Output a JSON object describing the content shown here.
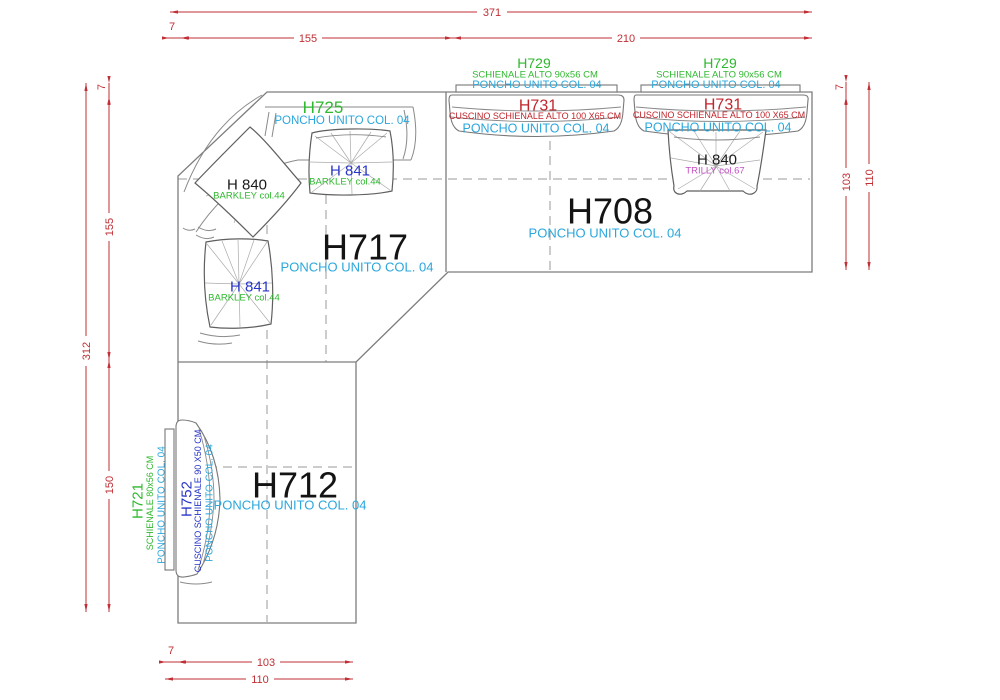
{
  "sections": {
    "h717": {
      "code": "H717",
      "fabric": "PONCHO UNITO COL. 04"
    },
    "h708": {
      "code": "H708",
      "fabric": "PONCHO UNITO COL. 04"
    },
    "h712": {
      "code": "H712",
      "fabric": "PONCHO UNITO COL. 04"
    },
    "h725": {
      "code": "H725",
      "fabric": "PONCHO UNITO COL. 04"
    }
  },
  "backrests": {
    "h729_left": {
      "code": "H729",
      "size": "SCHIENALE  ALTO 90x56 CM",
      "fabric": "PONCHO UNITO COL. 04"
    },
    "h729_right": {
      "code": "H729",
      "size": "SCHIENALE  ALTO 90x56 CM",
      "fabric": "PONCHO UNITO COL. 04"
    },
    "h731_left": {
      "code": "H731",
      "size": "CUSCINO SCHIENALE  ALTO 100 X65 CM",
      "fabric": "PONCHO UNITO COL. 04"
    },
    "h731_right": {
      "code": "H731",
      "size": "CUSCINO SCHIENALE  ALTO 100 X65 CM",
      "fabric": "PONCHO UNITO COL. 04"
    },
    "h721": {
      "code": "H721",
      "size": "SCHIENALE  80x56 CM",
      "fabric": "PONCHO UNITO COL. 04"
    },
    "h752": {
      "code": "H752",
      "size": "CUSCINO SCHIENALE  90 X50 CM",
      "fabric": "PONCHO UNITO COL. 04"
    }
  },
  "pillows": {
    "h840_left": {
      "code": "H 840",
      "fabric": "BARKLEY col.44"
    },
    "h841_top": {
      "code": "H 841",
      "fabric": "BARKLEY col.44"
    },
    "h841_bottom": {
      "code": "H 841",
      "fabric": "BARKLEY col.44"
    },
    "h840_right": {
      "code": "H 840",
      "fabric": "TRILLY col.67"
    }
  },
  "dimensions": {
    "top_total": "371",
    "top_offset": "7",
    "top_left": "155",
    "top_right": "210",
    "left_total": "312",
    "left_offset": "7",
    "left_upper": "155",
    "left_lower": "150",
    "right_offset": "7",
    "right_inner": "103",
    "right_total": "110",
    "bottom_offset": "7",
    "bottom_inner": "103",
    "bottom_total": "110"
  },
  "colors": {
    "dimension_red": "#c02f35",
    "fabric_cyan": "#2ba7dc",
    "code_green": "#2eb82e",
    "code_red": "#c0252c",
    "code_blue": "#2836c8",
    "pillow_magenta": "#c74fc7",
    "line_gray": "#7d7d7d"
  }
}
